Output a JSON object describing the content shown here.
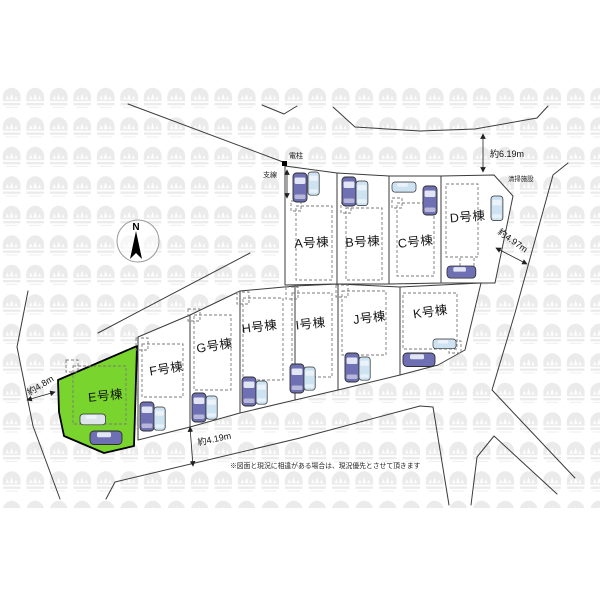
{
  "plan": {
    "type": "site-plan",
    "compass": {
      "north_label": "N"
    },
    "lots": [
      {
        "id": "A",
        "label": "A号棟",
        "highlighted": false
      },
      {
        "id": "B",
        "label": "B号棟",
        "highlighted": false
      },
      {
        "id": "C",
        "label": "C号棟",
        "highlighted": false
      },
      {
        "id": "D",
        "label": "D号棟",
        "highlighted": false
      },
      {
        "id": "E",
        "label": "E号棟",
        "highlighted": true
      },
      {
        "id": "F",
        "label": "F号棟",
        "highlighted": false
      },
      {
        "id": "G",
        "label": "G号棟",
        "highlighted": false
      },
      {
        "id": "H",
        "label": "H号棟",
        "highlighted": false
      },
      {
        "id": "I",
        "label": "I号棟",
        "highlighted": false
      },
      {
        "id": "J",
        "label": "J号棟",
        "highlighted": false
      },
      {
        "id": "K",
        "label": "K号棟",
        "highlighted": false
      }
    ],
    "annotations": {
      "utility_pole": "電柱",
      "guy_wire": "支線",
      "sanitation_facility": "清掃施設",
      "disclaimer_note": "※図面と現況に相違がある場合は、現況優先とさせて頂きます"
    },
    "dimensions": {
      "north_road_width": "約6.19m",
      "east_road_width": "約4.97m",
      "south_road_width": "約4.19m",
      "west_road_width": "約4.8m"
    },
    "colors": {
      "highlight_green": "#79d42e",
      "car_dark": "#6f6fb4",
      "car_light": "#cde3f2",
      "car_gray": "#dde4ea",
      "line": "#3b3b3b",
      "watermark": "#ebebeb"
    }
  }
}
